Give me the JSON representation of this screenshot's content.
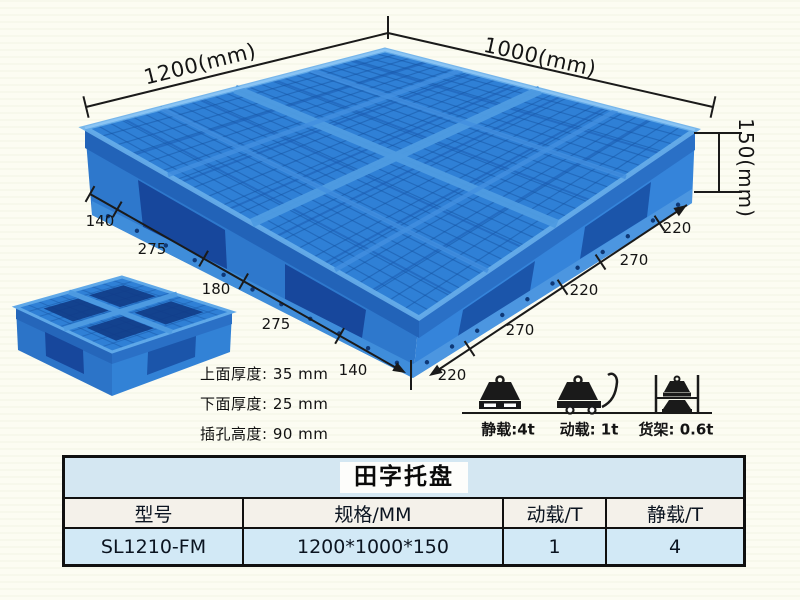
{
  "dims": {
    "top_left": "1200(mm)",
    "top_right": "1000(mm)",
    "height": "150(mm)",
    "left_chain": [
      "140",
      "275",
      "180",
      "275",
      "140"
    ],
    "right_chain": [
      "220",
      "270",
      "220",
      "270",
      "220"
    ]
  },
  "specs": [
    "上面厚度: 35 mm",
    "下面厚度: 25 mm",
    "插孔高度: 90 mm"
  ],
  "loads": [
    {
      "icon": "static-load-icon",
      "label": "静载:4t"
    },
    {
      "icon": "dynamic-load-icon",
      "label": "动载: 1t"
    },
    {
      "icon": "rack-load-icon",
      "label": "货架: 0.6t"
    }
  ],
  "product": {
    "table_title": "田字托盘",
    "headers": [
      "型号",
      "规格/MM",
      "动载/T",
      "静载/T"
    ],
    "rows": [
      [
        "SL1210-FM",
        "1200*1000*150",
        "1",
        "4"
      ]
    ]
  },
  "colors": {
    "pallet_blue": "#2f80d6",
    "pallet_dark_blue": "#17479c",
    "pallet_light_blue": "#5fa8e8",
    "annotation_line": "#1a1a1a",
    "table_title_bg": "#d4e7f2",
    "table_header_bg": "#f4f1ea",
    "table_row_bg": "#d2e9f6",
    "background": "#fcfcf2"
  }
}
